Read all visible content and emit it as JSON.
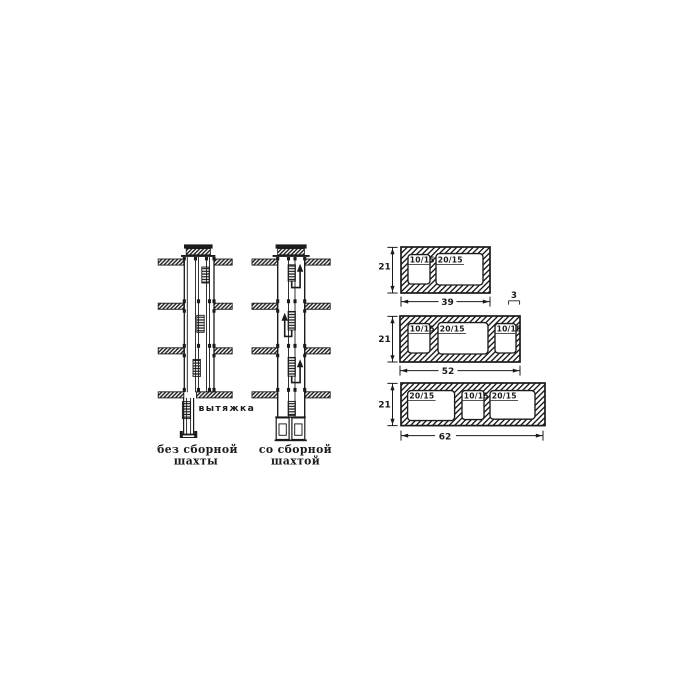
{
  "shaft_diagrams": {
    "left": {
      "caption_line1": "без сборной",
      "caption_line2": "шахты",
      "exhaust_label": "вытяжка"
    },
    "right": {
      "caption_line1": "со сборной",
      "caption_line2": "шахтой"
    }
  },
  "block_sections": [
    {
      "height_dim": "21",
      "width_dim": "39",
      "wall_dim": "3",
      "openings": [
        "10/15",
        "20/15"
      ]
    },
    {
      "height_dim": "21",
      "width_dim": "52",
      "openings": [
        "10/15",
        "20/15",
        "10/15"
      ]
    },
    {
      "height_dim": "21",
      "width_dim": "62",
      "openings": [
        "20/15",
        "10/15",
        "20/15"
      ]
    }
  ],
  "colors": {
    "ink": "#1b1b1b",
    "paper": "#ffffff"
  }
}
